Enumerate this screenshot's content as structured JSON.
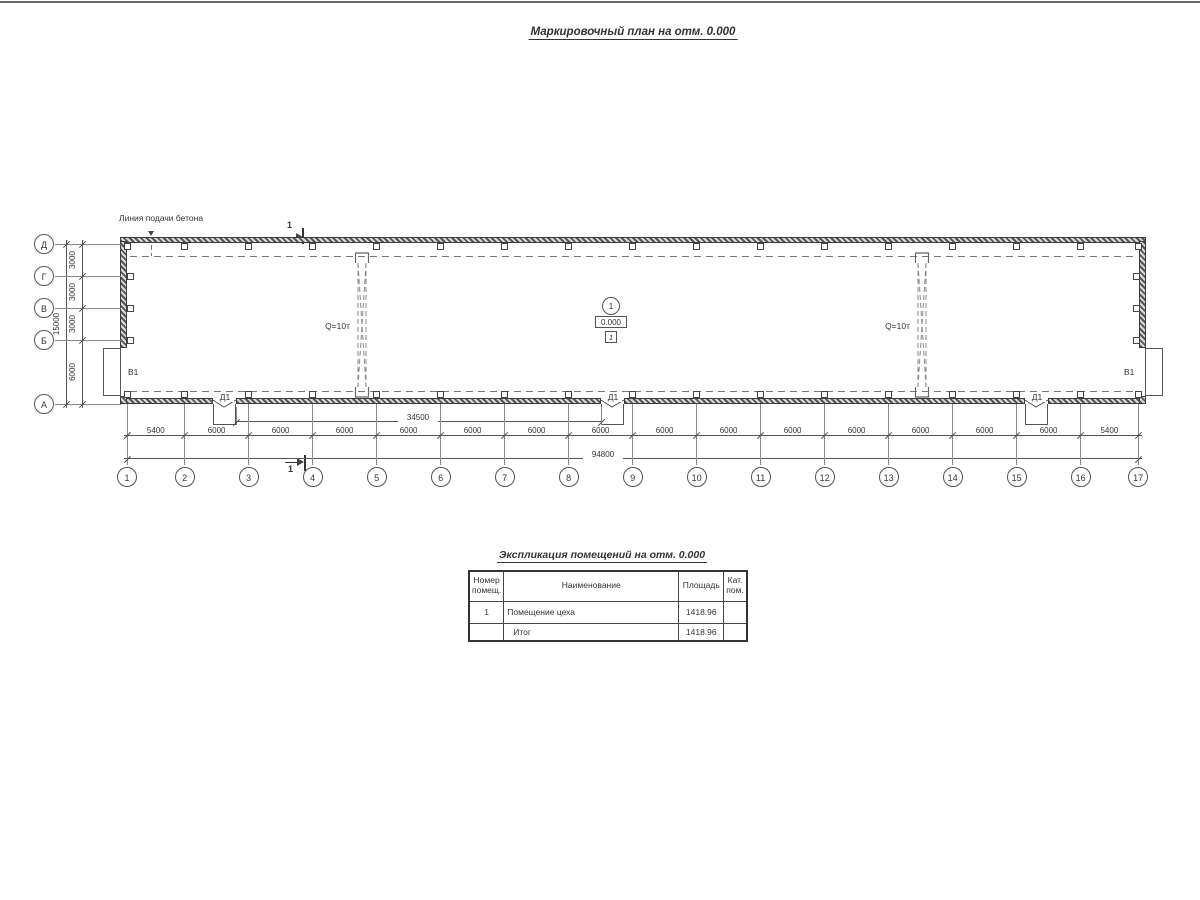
{
  "drawing": {
    "title": "Маркировочный план на отм. 0.000",
    "note_concrete_line": "Линия подачи бетона",
    "crane_capacity": "Q=10т",
    "section_number": "1",
    "level_node_number": "1",
    "level_elevation": "0.000",
    "room_tag": "1",
    "door_tag": "Д1",
    "gate_tag": "В1",
    "bottom_axes": [
      "1",
      "2",
      "3",
      "4",
      "5",
      "6",
      "7",
      "8",
      "9",
      "10",
      "11",
      "12",
      "13",
      "14",
      "15",
      "16",
      "17"
    ],
    "left_axes": [
      "Д",
      "Г",
      "В",
      "Б",
      "А"
    ],
    "bottom_bay_dims": [
      "5400",
      "6000",
      "6000",
      "6000",
      "6000",
      "6000",
      "6000",
      "6000",
      "6000",
      "6000",
      "6000",
      "6000",
      "6000",
      "6000",
      "6000",
      "5400"
    ],
    "bottom_doors_dim": "34500",
    "bottom_total_dim": "94800",
    "left_bay_dims": [
      "3000",
      "3000",
      "3000",
      "6000"
    ],
    "left_total_dim": "15000"
  },
  "schedule": {
    "title": "Экспликация помещений на отм. 0.000",
    "headers": [
      "Номер помещ.",
      "Наименование",
      "Площадь",
      "Кат. пом."
    ],
    "rows": [
      [
        "1",
        "Помещение цеха",
        "1418.96",
        ""
      ],
      [
        "",
        "Итог",
        "1418.96",
        ""
      ]
    ]
  }
}
